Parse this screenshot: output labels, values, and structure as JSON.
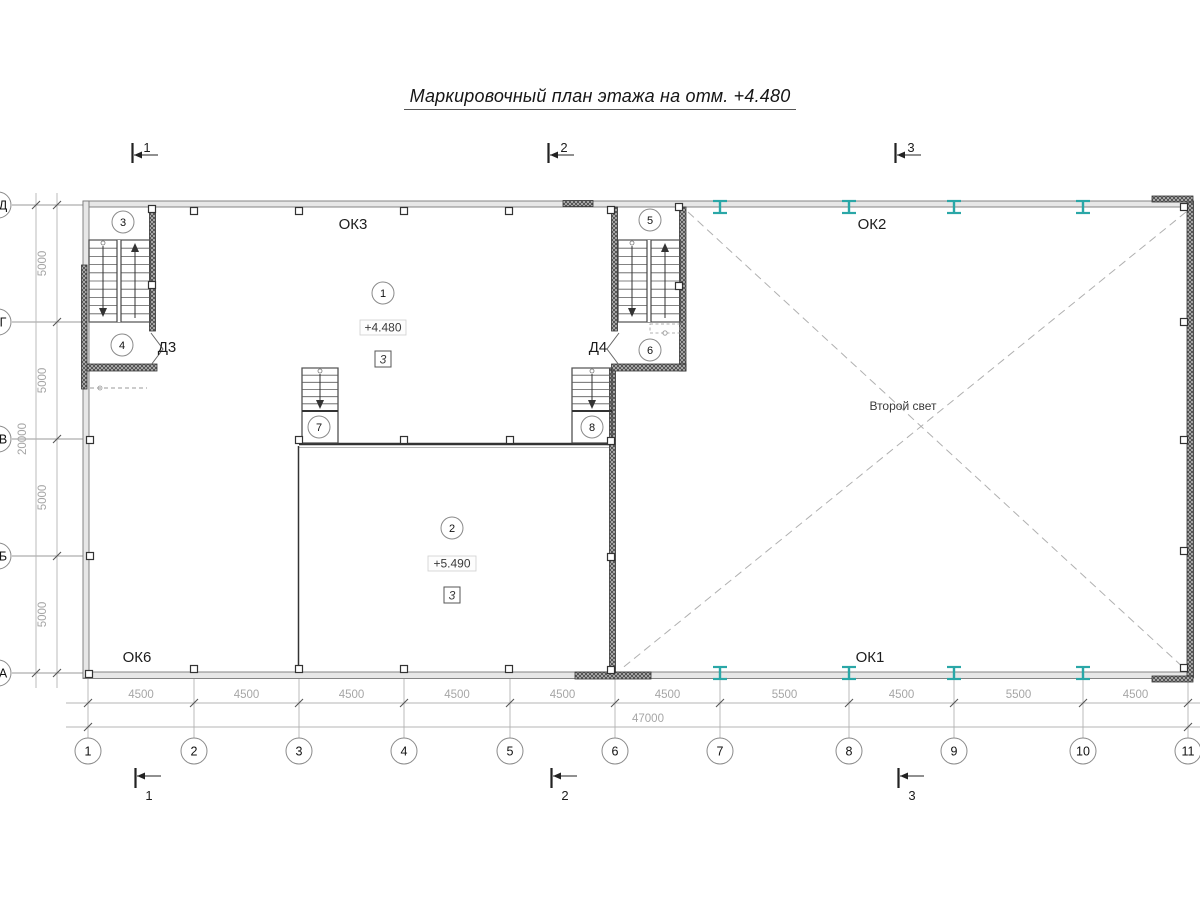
{
  "title": "Маркировочный план этажа на отм. +4.480",
  "section_marks": {
    "top": [
      "1",
      "2",
      "3"
    ],
    "bottom": [
      "1",
      "2",
      "3"
    ]
  },
  "axes": {
    "columns": [
      "1",
      "2",
      "3",
      "4",
      "5",
      "6",
      "7",
      "8",
      "9",
      "10",
      "11"
    ],
    "rows": [
      "Д",
      "Г",
      "В",
      "Б",
      "А"
    ]
  },
  "dimensions": {
    "bottom_segments": [
      "4500",
      "4500",
      "4500",
      "4500",
      "4500",
      "4500",
      "5500",
      "4500",
      "5500",
      "4500"
    ],
    "bottom_total": "47000",
    "left_segments": [
      "5000",
      "5000",
      "5000",
      "5000"
    ],
    "left_total": "20000"
  },
  "windows": {
    "top_left": "ОК3",
    "top_right": "ОК2",
    "bottom_left": "ОК6",
    "bottom_right": "ОК1"
  },
  "doors": {
    "left": "Д3",
    "middle": "Д4"
  },
  "rooms": [
    {
      "mark": "1",
      "elevation": "+4.480",
      "note": "3"
    },
    {
      "mark": "2",
      "elevation": "+5.490",
      "note": "3"
    }
  ],
  "stairs": {
    "marks": [
      "3",
      "4",
      "5",
      "6",
      "7",
      "8"
    ]
  },
  "annotations": {
    "second_light": "Второй свет"
  },
  "colors": {
    "beam": "#2aa7a7",
    "line": "#2e2e2e",
    "dim_text": "#a6a6a6",
    "light_line": "#b4b4b4"
  }
}
